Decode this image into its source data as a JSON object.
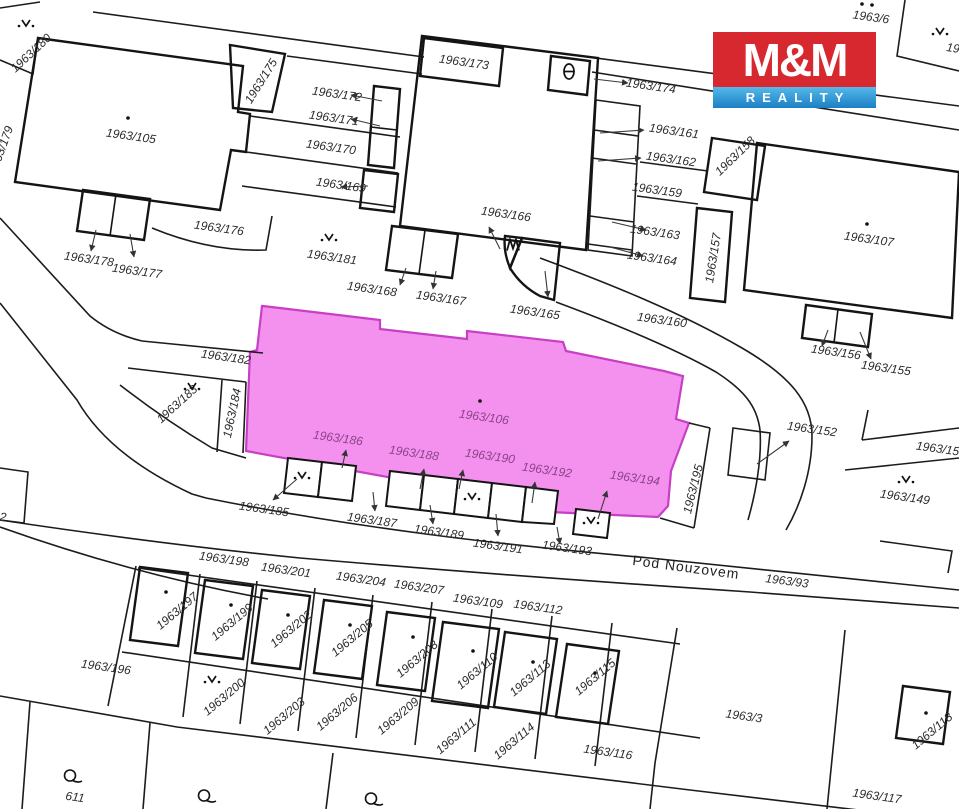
{
  "logo": {
    "line1": "M&M",
    "line2": "REALITY",
    "red": "#d7282f",
    "blue_top": "#55b9ea",
    "blue_bottom": "#1b7fc4"
  },
  "map": {
    "highlight": {
      "parcel": "1963/106",
      "fill": "#f491ee",
      "stroke": "#c73fc4"
    },
    "street": {
      "name": "Pod Nouzovem",
      "parcel": "1963/93"
    },
    "labels": [
      {
        "t": "1963/180",
        "x": 31,
        "y": 53,
        "r": -43
      },
      {
        "t": "1963/179",
        "x": 1,
        "y": 150,
        "r": -70
      },
      {
        "t": "1963/105",
        "x": 131,
        "y": 136,
        "r": 8
      },
      {
        "t": "1963/175",
        "x": 261,
        "y": 81,
        "r": -58
      },
      {
        "t": "1963/176",
        "x": 219,
        "y": 228,
        "r": 8
      },
      {
        "t": "1963/178",
        "x": 89,
        "y": 259,
        "r": 8
      },
      {
        "t": "1963/177",
        "x": 137,
        "y": 271,
        "r": 8
      },
      {
        "t": "1963/172",
        "x": 337,
        "y": 94,
        "r": 8
      },
      {
        "t": "1963/171",
        "x": 334,
        "y": 118,
        "r": 8
      },
      {
        "t": "1963/170",
        "x": 331,
        "y": 147,
        "r": 8
      },
      {
        "t": "1963/169",
        "x": 341,
        "y": 185,
        "r": 8
      },
      {
        "t": "1963/173",
        "x": 464,
        "y": 62,
        "r": 8
      },
      {
        "t": "1963/174",
        "x": 651,
        "y": 86,
        "r": 8
      },
      {
        "t": "1963/6",
        "x": 871,
        "y": 17,
        "r": 8
      },
      {
        "t": "19",
        "x": 953,
        "y": 48,
        "r": 8
      },
      {
        "t": "1963/161",
        "x": 674,
        "y": 131,
        "r": 8
      },
      {
        "t": "1963/162",
        "x": 671,
        "y": 159,
        "r": 8
      },
      {
        "t": "1963/159",
        "x": 657,
        "y": 190,
        "r": 8
      },
      {
        "t": "1963/163",
        "x": 655,
        "y": 232,
        "r": 8
      },
      {
        "t": "1963/164",
        "x": 652,
        "y": 258,
        "r": 8
      },
      {
        "t": "1963/166",
        "x": 506,
        "y": 214,
        "r": 8
      },
      {
        "t": "1963/181",
        "x": 332,
        "y": 257,
        "r": 8
      },
      {
        "t": "1963/168",
        "x": 372,
        "y": 289,
        "r": 8
      },
      {
        "t": "1963/167",
        "x": 441,
        "y": 298,
        "r": 8
      },
      {
        "t": "1963/165",
        "x": 535,
        "y": 312,
        "r": 8
      },
      {
        "t": "1963/160",
        "x": 662,
        "y": 320,
        "r": 8
      },
      {
        "t": "1963/158",
        "x": 735,
        "y": 156,
        "r": -44
      },
      {
        "t": "1963/157",
        "x": 713,
        "y": 258,
        "r": -81
      },
      {
        "t": "1963/107",
        "x": 869,
        "y": 239,
        "r": 8
      },
      {
        "t": "1963/156",
        "x": 836,
        "y": 352,
        "r": 8
      },
      {
        "t": "1963/155",
        "x": 886,
        "y": 368,
        "r": 8
      },
      {
        "t": "1963/152",
        "x": 812,
        "y": 429,
        "r": 8
      },
      {
        "t": "1963/150",
        "x": 941,
        "y": 449,
        "r": 8
      },
      {
        "t": "1963/149",
        "x": 905,
        "y": 497,
        "r": 8
      },
      {
        "t": "1963/182",
        "x": 226,
        "y": 357,
        "r": 8
      },
      {
        "t": "1963/183",
        "x": 177,
        "y": 404,
        "r": -42
      },
      {
        "t": "1963/184",
        "x": 232,
        "y": 413,
        "r": -78
      },
      {
        "t": "1963/185",
        "x": 264,
        "y": 509,
        "r": 8
      },
      {
        "t": "1963/187",
        "x": 372,
        "y": 520,
        "r": 8
      },
      {
        "t": "1963/189",
        "x": 439,
        "y": 532,
        "r": 8
      },
      {
        "t": "1963/191",
        "x": 498,
        "y": 546,
        "r": 8
      },
      {
        "t": "1963/193",
        "x": 567,
        "y": 548,
        "r": 8
      },
      {
        "t": "1963/195",
        "x": 693,
        "y": 489,
        "r": -76
      },
      {
        "t": "Pod Nouzovem",
        "x": 686,
        "y": 567,
        "r": 7.5,
        "v": "street"
      },
      {
        "t": "1963/93",
        "x": 787,
        "y": 581,
        "r": 7.5
      },
      {
        "t": "1963/106",
        "x": 484,
        "y": 417,
        "r": 8,
        "v": "magenta"
      },
      {
        "t": "1963/186",
        "x": 338,
        "y": 438,
        "r": 8,
        "v": "magenta"
      },
      {
        "t": "1963/188",
        "x": 414,
        "y": 453,
        "r": 8,
        "v": "magenta"
      },
      {
        "t": "1963/190",
        "x": 490,
        "y": 456,
        "r": 8,
        "v": "magenta"
      },
      {
        "t": "1963/192",
        "x": 547,
        "y": 470,
        "r": 8,
        "v": "magenta"
      },
      {
        "t": "1963/194",
        "x": 635,
        "y": 478,
        "r": 8,
        "v": "magenta"
      },
      {
        "t": "1963/196",
        "x": 106,
        "y": 667,
        "r": 8
      },
      {
        "t": "1963/197",
        "x": 177,
        "y": 611,
        "r": -40
      },
      {
        "t": "1963/198",
        "x": 224,
        "y": 559,
        "r": 8
      },
      {
        "t": "1963/199",
        "x": 232,
        "y": 622,
        "r": -40
      },
      {
        "t": "1963/200",
        "x": 224,
        "y": 697,
        "r": -40
      },
      {
        "t": "1963/201",
        "x": 286,
        "y": 570,
        "r": 8
      },
      {
        "t": "1963/202",
        "x": 291,
        "y": 629,
        "r": -40
      },
      {
        "t": "1963/203",
        "x": 284,
        "y": 716,
        "r": -40
      },
      {
        "t": "1963/204",
        "x": 361,
        "y": 579,
        "r": 8
      },
      {
        "t": "1963/205",
        "x": 352,
        "y": 638,
        "r": -40
      },
      {
        "t": "1963/206",
        "x": 337,
        "y": 712,
        "r": -40
      },
      {
        "t": "1963/207",
        "x": 419,
        "y": 587,
        "r": 8
      },
      {
        "t": "1963/208",
        "x": 417,
        "y": 659,
        "r": -40
      },
      {
        "t": "1963/209",
        "x": 398,
        "y": 716,
        "r": -40
      },
      {
        "t": "1963/109",
        "x": 478,
        "y": 601,
        "r": 8
      },
      {
        "t": "1963/110",
        "x": 477,
        "y": 671,
        "r": -40
      },
      {
        "t": "1963/111",
        "x": 456,
        "y": 736,
        "r": -40
      },
      {
        "t": "1963/112",
        "x": 538,
        "y": 607,
        "r": 8
      },
      {
        "t": "1963/113",
        "x": 530,
        "y": 678,
        "r": -40
      },
      {
        "t": "1963/114",
        "x": 514,
        "y": 741,
        "r": -40
      },
      {
        "t": "1963/115",
        "x": 595,
        "y": 677,
        "r": -40
      },
      {
        "t": "1963/116",
        "x": 608,
        "y": 752,
        "r": 8
      },
      {
        "t": "1963/3",
        "x": 744,
        "y": 716,
        "r": 8
      },
      {
        "t": "1963/117",
        "x": 877,
        "y": 796,
        "r": 8
      },
      {
        "t": "1963/118",
        "x": 932,
        "y": 731,
        "r": -40
      },
      {
        "t": "611",
        "x": 75,
        "y": 797,
        "r": 8
      },
      {
        "t": "2",
        "x": 3,
        "y": 517,
        "r": 8
      }
    ],
    "symbols": [
      {
        "type": "v-dots",
        "x": 26,
        "y": 25
      },
      {
        "type": "v-dots",
        "x": 329,
        "y": 239
      },
      {
        "type": "v-dots",
        "x": 192,
        "y": 388
      },
      {
        "type": "v-dots",
        "x": 302,
        "y": 477
      },
      {
        "type": "v-dots",
        "x": 472,
        "y": 498
      },
      {
        "type": "v-dots",
        "x": 591,
        "y": 522
      },
      {
        "type": "v-dots",
        "x": 906,
        "y": 481
      },
      {
        "type": "v-dots",
        "x": 212,
        "y": 681
      },
      {
        "type": "v-dots",
        "x": 940,
        "y": 33
      },
      {
        "type": "theta",
        "x": 569,
        "y": 74
      },
      {
        "type": "wedge",
        "x": 513,
        "y": 247
      },
      {
        "type": "circle-tail",
        "x": 73,
        "y": 778
      },
      {
        "type": "circle-tail",
        "x": 207,
        "y": 798
      },
      {
        "type": "circle-tail",
        "x": 374,
        "y": 801
      },
      {
        "type": "dot",
        "x": 128,
        "y": 117
      },
      {
        "type": "dot",
        "x": 480,
        "y": 400
      },
      {
        "type": "dot",
        "x": 867,
        "y": 223
      },
      {
        "type": "dot",
        "x": 166,
        "y": 591
      },
      {
        "type": "dot",
        "x": 231,
        "y": 604
      },
      {
        "type": "dot",
        "x": 288,
        "y": 614
      },
      {
        "type": "dot",
        "x": 350,
        "y": 624
      },
      {
        "type": "dot",
        "x": 413,
        "y": 636
      },
      {
        "type": "dot",
        "x": 473,
        "y": 650
      },
      {
        "type": "dot",
        "x": 533,
        "y": 661
      },
      {
        "type": "dot",
        "x": 595,
        "y": 672
      },
      {
        "type": "dot",
        "x": 926,
        "y": 712
      },
      {
        "type": "dot",
        "x": 862,
        "y": 3
      },
      {
        "type": "dot",
        "x": 872,
        "y": 4
      }
    ]
  }
}
